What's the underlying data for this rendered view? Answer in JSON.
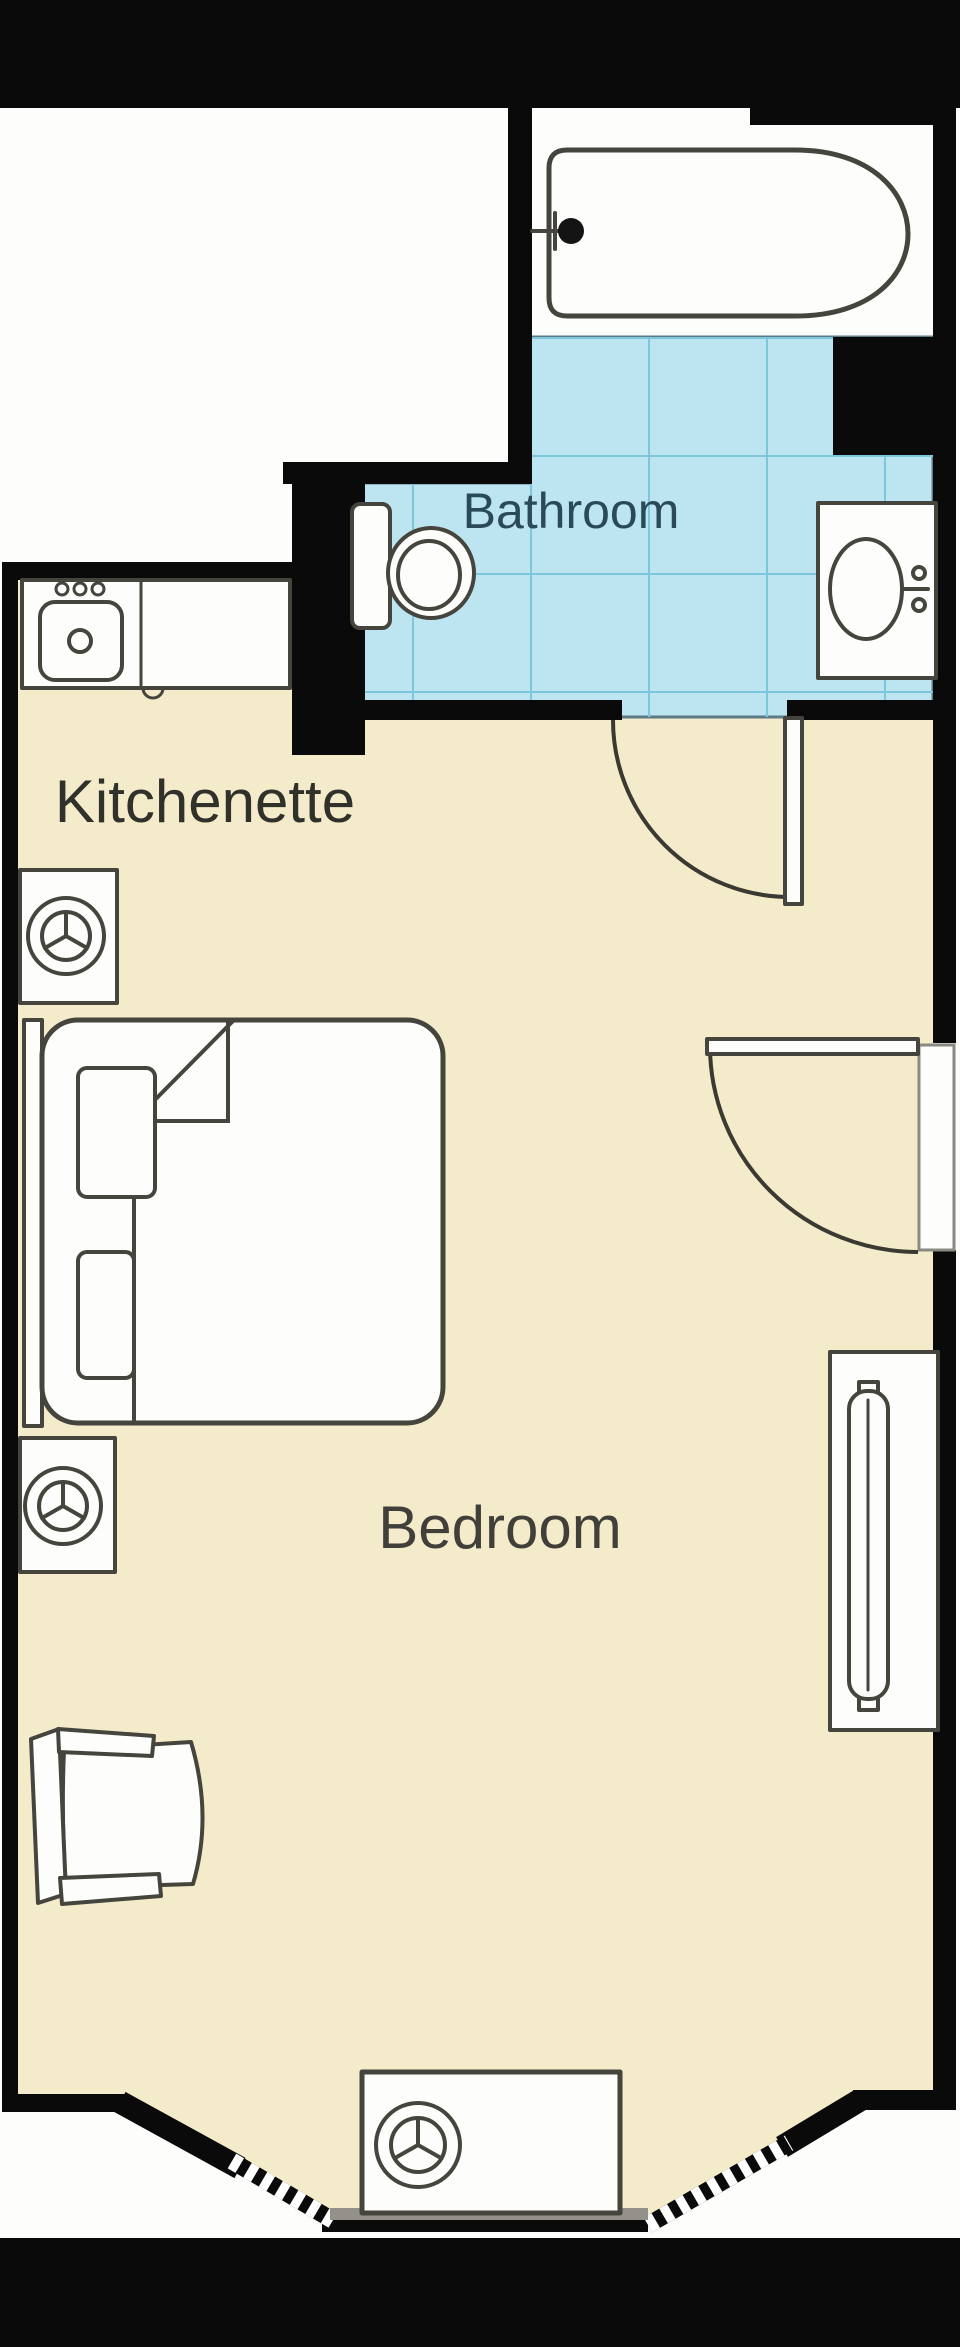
{
  "plan": {
    "type": "floor-plan",
    "rooms": {
      "bathroom": {
        "label": "Bathroom"
      },
      "kitchenette": {
        "label": "Kitchenette"
      },
      "bedroom": {
        "label": "Bedroom"
      }
    },
    "fixtures": [
      "bathtub-icon",
      "bath-faucet-icon",
      "toilet-icon",
      "bathroom-sink-icon",
      "kitchen-counter",
      "kitchen-sink-icon",
      "stove-knobs-icon",
      "fan-symbol-icon",
      "bed",
      "pillow",
      "blanket-fold",
      "armchair",
      "radiator-icon",
      "door-swing-arc",
      "bay-window"
    ],
    "colors": {
      "wall": "#0a0a0a",
      "floor": "#f4ebcb",
      "tile": "#bde5f1",
      "tileline": "#7cc7db",
      "tileedge": "#5d7a85",
      "stroke": "#45453e",
      "lblbath": "#2b4a58",
      "lblkitchen": "#31312c",
      "lblbed": "#403f39",
      "bg": "#fdfdfb"
    }
  }
}
